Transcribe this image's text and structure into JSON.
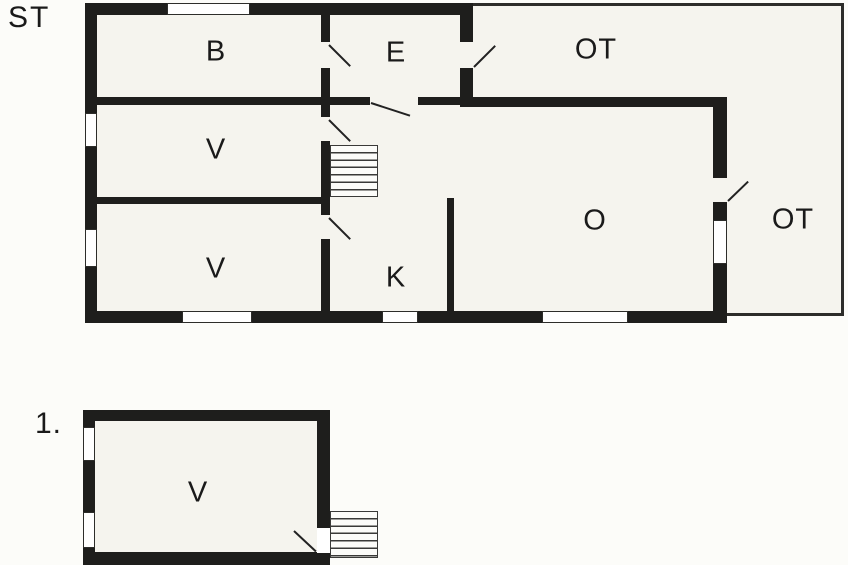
{
  "floor_plan": {
    "ground": {
      "floor_label": "ST",
      "rooms": [
        {
          "key": "b",
          "label": "B"
        },
        {
          "key": "e",
          "label": "E"
        },
        {
          "key": "ot_top",
          "label": "OT"
        },
        {
          "key": "v_upper",
          "label": "V"
        },
        {
          "key": "v_lower",
          "label": "V"
        },
        {
          "key": "k",
          "label": "K"
        },
        {
          "key": "o",
          "label": "O"
        },
        {
          "key": "ot_right",
          "label": "OT"
        }
      ],
      "stairs_treads": 7,
      "window_count": 7,
      "door_count": 6
    },
    "first": {
      "floor_label": "1.",
      "rooms": [
        {
          "key": "v",
          "label": "V"
        }
      ],
      "stairs_treads": 7,
      "window_count": 2,
      "door_count": 1
    },
    "colors": {
      "wall": "#1e1e1c",
      "room_fill": "#f5f4ee",
      "background": "#fcfcf9",
      "window_fill": "#ffffff",
      "thin_line": "#2d2d2a",
      "text": "#1a1a1a"
    }
  }
}
